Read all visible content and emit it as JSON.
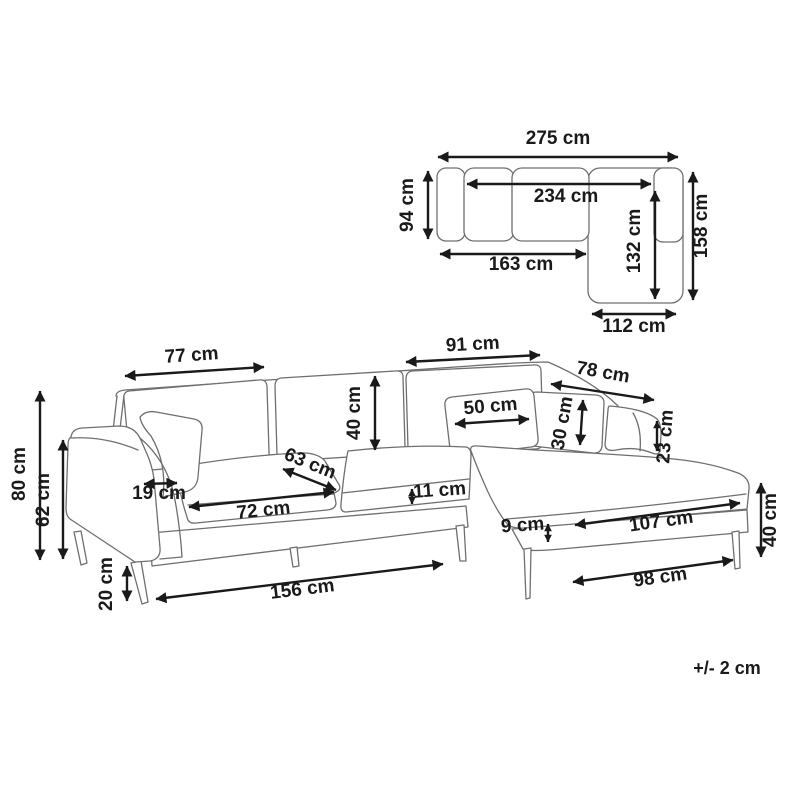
{
  "diagram": {
    "tolerance_note": "+/- 2 cm",
    "colors": {
      "background": "#ffffff",
      "sofa_line": "#6f6f6f",
      "dimension": "#1a1a1a"
    }
  },
  "top_view": {
    "dims": {
      "overall_width": "275 cm",
      "body_depth": "94 cm",
      "inner_width": "234 cm",
      "chaise_inner_length": "132 cm",
      "overall_depth": "158 cm",
      "left_section_length": "163 cm",
      "chaise_width": "112 cm"
    }
  },
  "front_view": {
    "dims": {
      "left_back_cushion_width": "77 cm",
      "right_back_cushion_width": "91 cm",
      "chaise_back_width": "78 cm",
      "back_cushion_height": "40 cm",
      "pillow_width": "50 cm",
      "pillow_height": "30 cm",
      "right_armrest_height": "23 cm",
      "overall_height": "80 cm",
      "armrest_height": "62 cm",
      "armrest_width": "19 cm",
      "seat_depth": "63 cm",
      "seat_cushion_width": "72 cm",
      "seat_cushion_thickness": "11 cm",
      "base_rail_height": "9 cm",
      "chaise_seat_length": "107 cm",
      "chaise_height": "40 cm",
      "leg_height": "20 cm",
      "base_front_length": "156 cm",
      "chaise_base_length": "98 cm"
    }
  }
}
